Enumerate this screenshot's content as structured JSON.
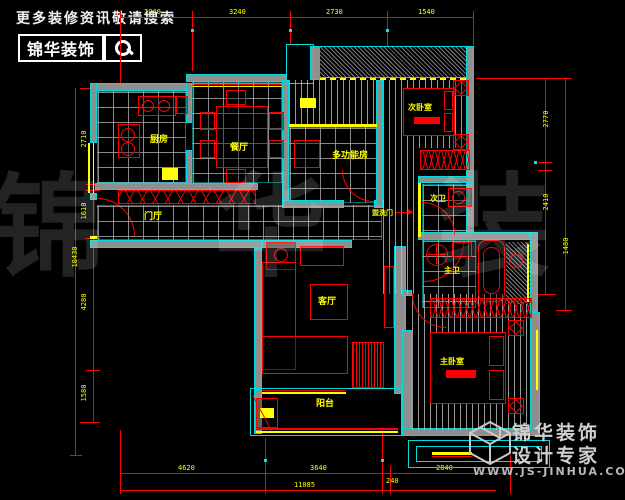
{
  "branding": {
    "tagline": "更多装修资讯敬请搜索",
    "logo_text": "锦华装饰",
    "watermark": "锦 华 装 饰",
    "footer_line1": "锦华装饰",
    "footer_line2": "设计专家",
    "website": "WWW.JS-JINHUA.COM"
  },
  "rooms": {
    "kitchen": "厨房",
    "dining": "餐厅",
    "multi": "多功能房",
    "bedroom2": "次卧室",
    "hall": "门厅",
    "bath2": "次卫",
    "wash_door": "盥洗门",
    "living": "客厅",
    "bath1": "主卫",
    "bedroom1": "主卧室",
    "balcony": "阳台"
  },
  "dims": {
    "top": [
      "2040",
      "3240",
      "2730",
      "1540"
    ],
    "left": [
      "2710",
      "1610",
      "4280",
      "1580"
    ],
    "left_total": "10430",
    "right": [
      "2770",
      "2410"
    ],
    "right_outer": "1480",
    "bottom": [
      "4620",
      "3640",
      "240",
      "2840"
    ],
    "bottom_total": "11085"
  },
  "colors": {
    "wall_line": "#00dcdc",
    "fixture": "#ff0000",
    "text": "#ffff00",
    "background": "#000000"
  }
}
